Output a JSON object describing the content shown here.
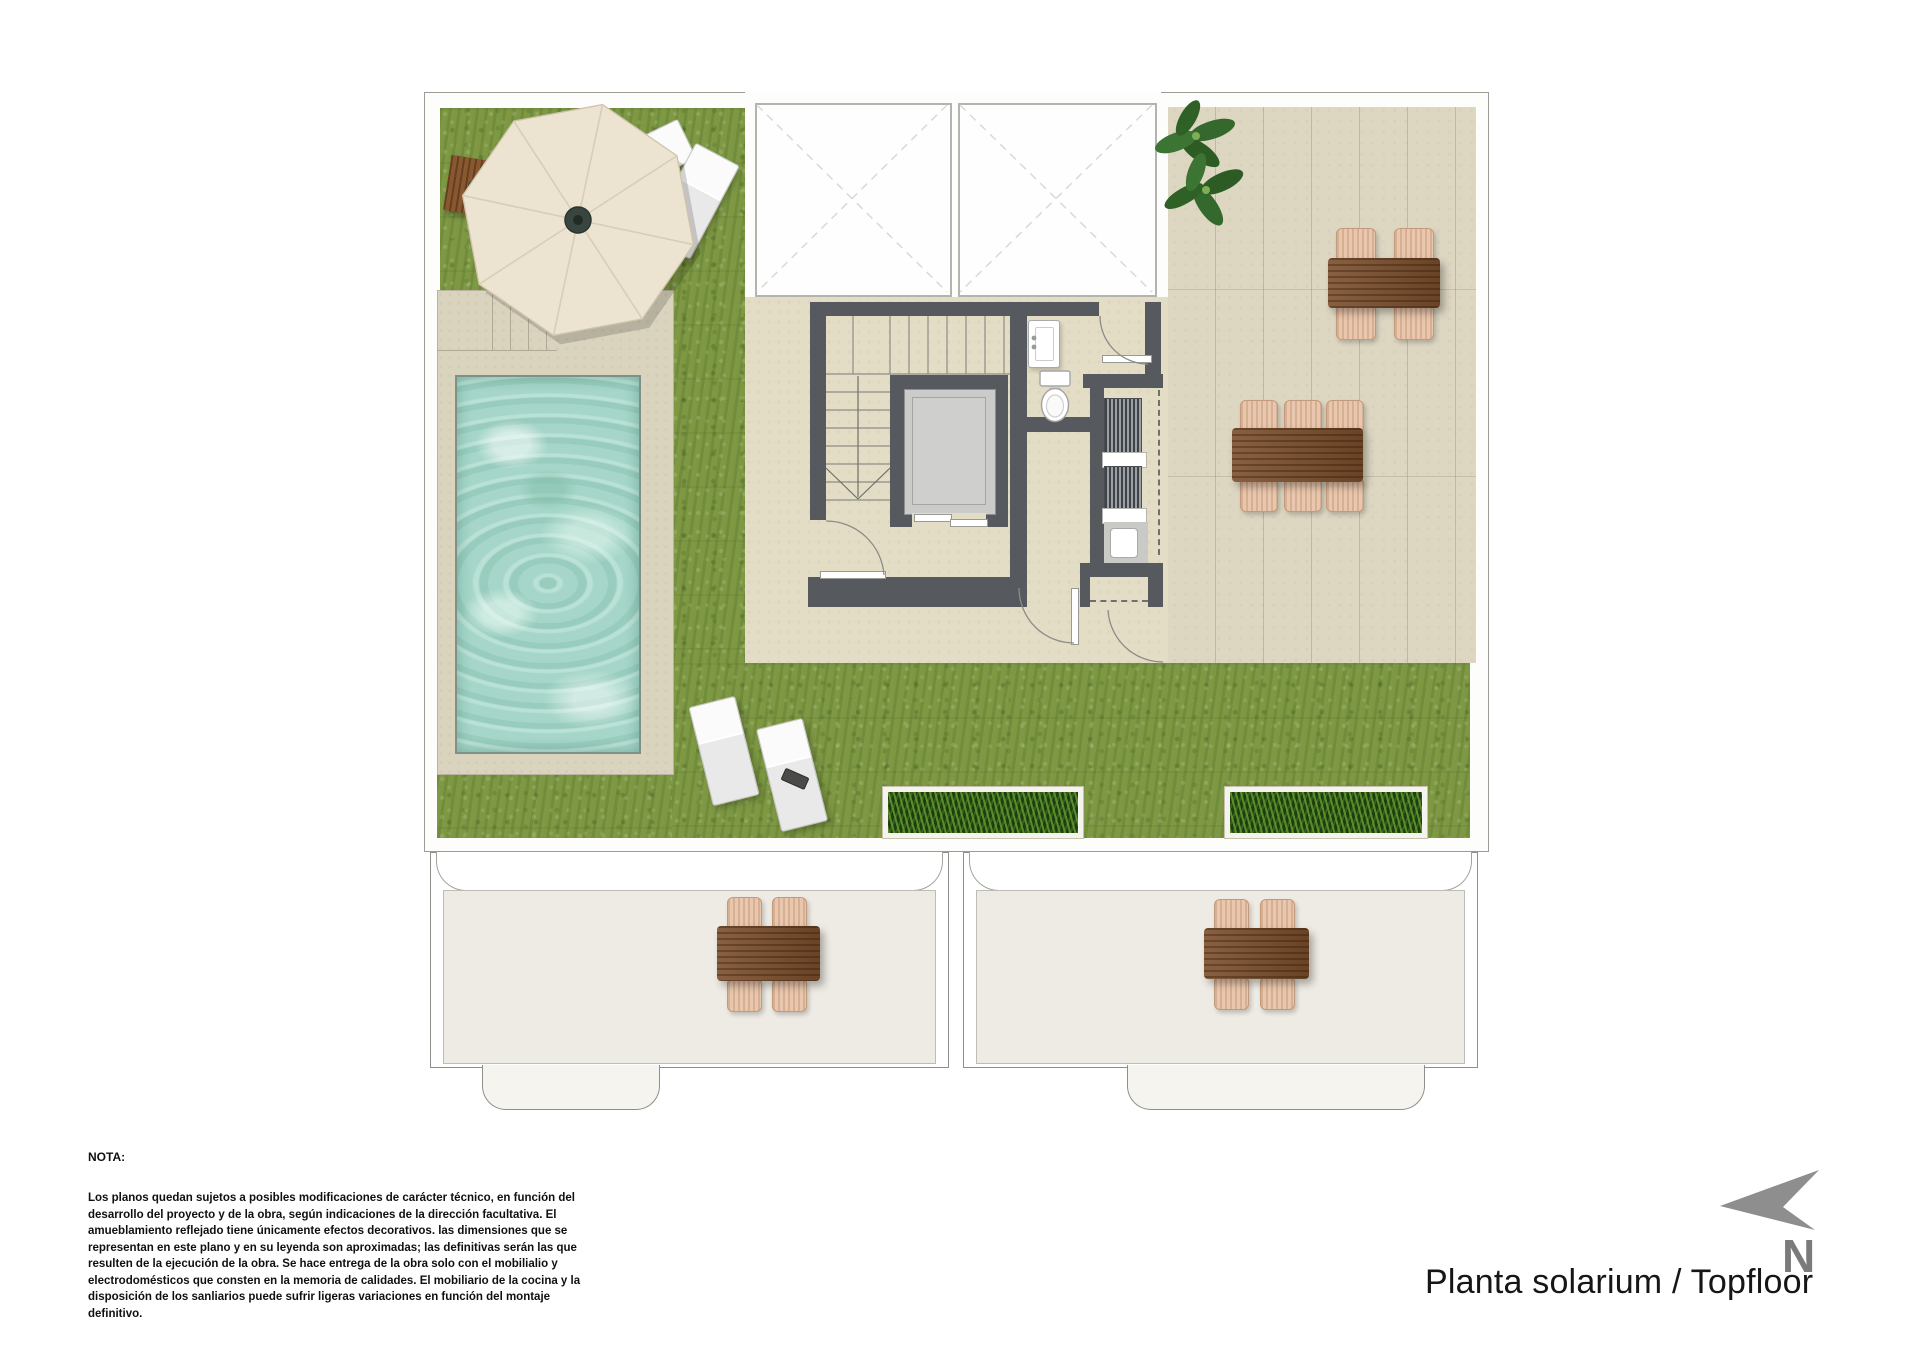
{
  "document": {
    "title": "Planta solarium / Topfloor",
    "compass_label": "N",
    "note_heading": "NOTA:",
    "note_body": "Los planos quedan sujetos a posibles modificaciones de carácter técnico, en función del desarrollo del proyecto y de la obra, según indicaciones de la dirección facultativa. El amueblamiento reflejado tiene únicamente efectos decorativos. las dimensiones que se representan en este plano y en su leyenda son aproximadas; las definitivas serán las que resulten de la ejecución de la obra. Se hace entrega de la obra solo con el mobilialio y electrodomésticos que consten en la memoria de calidades. El mobiliario de la cocina y la disposición de los sanliarios puede sufrir ligeras variaciones en función del montaje definitivo."
  },
  "plan": {
    "features": [
      "lawn",
      "swimming-pool",
      "pool-deck",
      "cantilever-parasol",
      "sun-loungers",
      "skylights",
      "staircase",
      "elevator",
      "toilet",
      "washbasin",
      "ventilation-louvers",
      "utility-appliance",
      "roof-terrace",
      "potted-plant",
      "dining-table-6-seats",
      "dining-table-4-seats",
      "planters",
      "lower-terraces",
      "north-arrow"
    ],
    "colors": {
      "lawn": "#7d9743",
      "water": "#a5d6c9",
      "walls": "#56595d",
      "terrace_tile": "#ddd7c2",
      "pool_deck": "#dad4bf",
      "wood_furniture": "#7b4e2b",
      "wicker_chair": "#e8c7ae",
      "parasol": "#ece3d1",
      "compass": "#8f8f8f"
    }
  }
}
